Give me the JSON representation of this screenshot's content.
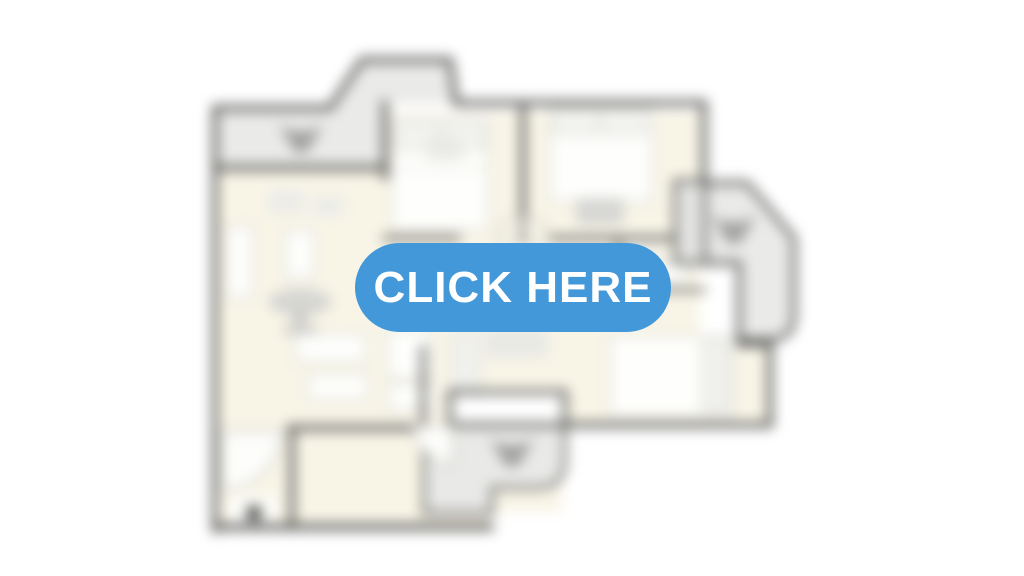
{
  "page": {
    "background": "#ffffff",
    "description": "Blurred apartment floor plan teaser with call-to-action button"
  },
  "cta": {
    "label": "CLICK HERE",
    "background_color": "#4298d8",
    "text_color": "#ffffff"
  },
  "floorplan": {
    "blurred": true,
    "colors": {
      "walls": "#5d5d5b",
      "floor": "#f8f5e7",
      "balcony": "#eaeae8",
      "furniture_fill": "#fefefc",
      "furniture_outline": "#d8d8d4",
      "vent_icon": "#a2a2a0"
    },
    "icons": [
      "vent-icon-top-left-balcony",
      "vent-icon-right-balcony",
      "vent-icon-bottom-balcony"
    ]
  }
}
